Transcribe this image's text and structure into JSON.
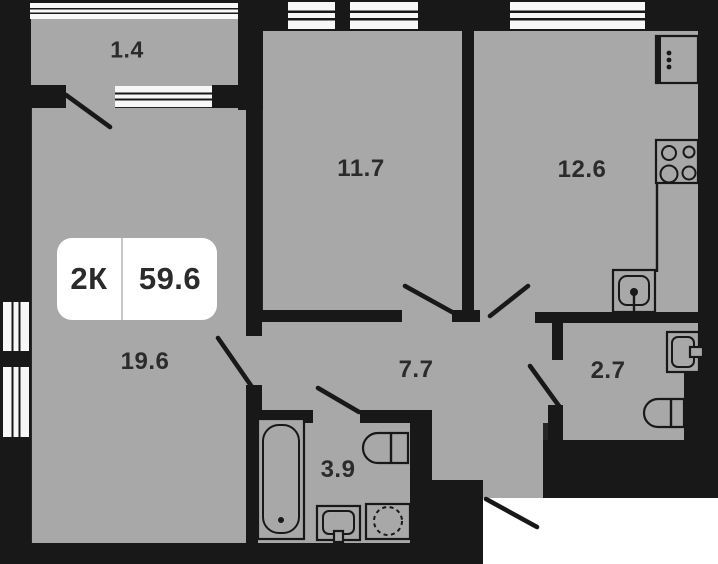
{
  "plan_card": {
    "badge": {
      "rooms_label": "2К",
      "total_area": "59.6"
    },
    "rooms": [
      {
        "name": "balcony",
        "area": "1.4"
      },
      {
        "name": "bedroom",
        "area": "11.7"
      },
      {
        "name": "kitchen",
        "area": "12.6"
      },
      {
        "name": "living-room",
        "area": "19.6"
      },
      {
        "name": "hallway",
        "area": "7.7"
      },
      {
        "name": "toilet",
        "area": "2.7"
      },
      {
        "name": "bathroom",
        "area": "3.9"
      }
    ],
    "fixtures": [
      "fridge",
      "stove",
      "kitchen-sink",
      "wc-sink",
      "toilet",
      "bathtub",
      "bathroom-sink",
      "washing-machine"
    ],
    "colors": {
      "floor": "#a8a8a8",
      "wall": "#181818",
      "bg": "#262626",
      "outside": "#ffffff",
      "window": "#f7f7f7",
      "badge-bg": "#ffffff",
      "label": "#2b2b2b"
    }
  }
}
